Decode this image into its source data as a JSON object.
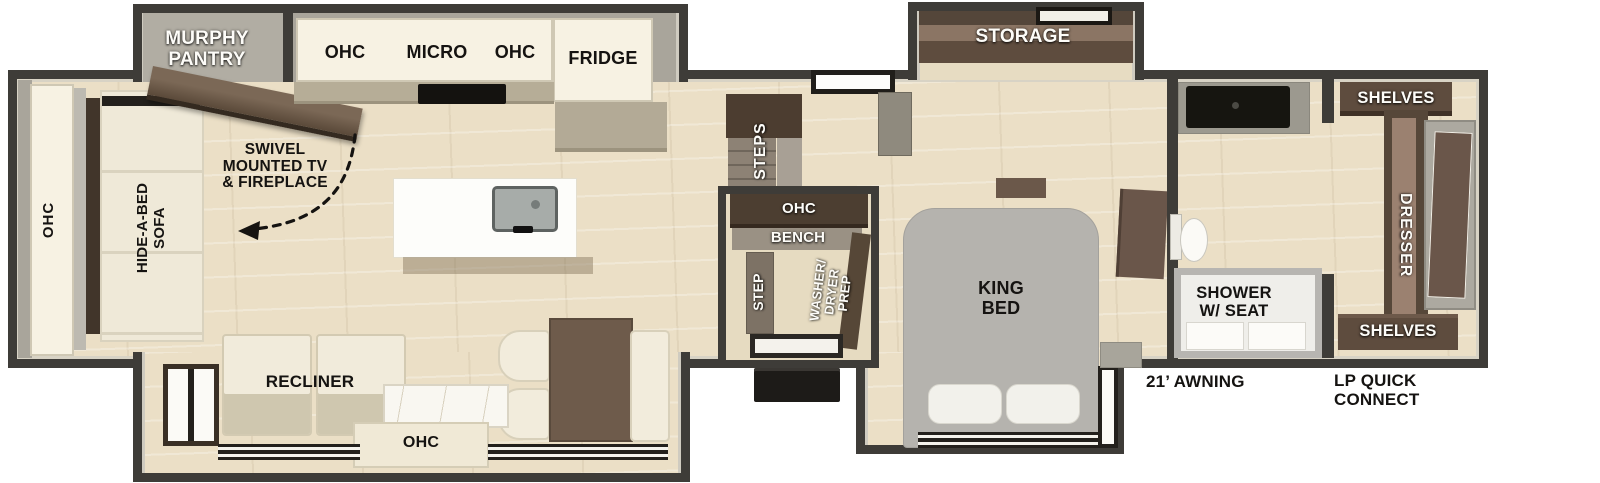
{
  "colors": {
    "wall_dark": "#3E3C38",
    "wall_gray": "#A9A59B",
    "floor_tan": "#EBDFC6",
    "cabinet_white": "#F7F2E3",
    "wood_dark_brown": "#4C3D30",
    "wood_brown": "#6A564A",
    "wood_mid_brown": "#8B7564",
    "bed_gray": "#B5B3AE",
    "upholstery_cream": "#F1EBDB",
    "black_fixture": "#1D1B18"
  },
  "labels": {
    "ohc_rear": "OHC",
    "hide_a_bed": "HIDE-A-BED\nSOFA",
    "murphy_pantry": "MURPHY\nPANTRY",
    "swivel_tv": "SWIVEL\nMOUNTED TV\n& FIREPLACE",
    "kitchen_ohc_left": "OHC",
    "kitchen_micro": "MICRO",
    "kitchen_ohc_right": "OHC",
    "fridge": "FRIDGE",
    "steps": "STEPS",
    "mid_ohc": "OHC",
    "bench": "BENCH",
    "step": "STEP",
    "washer_prep": "WASHER/\nDRYER\nPREP",
    "storage": "STORAGE",
    "king_bed": "KING\nBED",
    "shower": "SHOWER\nW/ SEAT",
    "shelves_top": "SHELVES",
    "dresser": "DRESSER",
    "shelves_bottom": "SHELVES",
    "recliner": "RECLINER",
    "ohc_bottom": "OHC",
    "awning": "21’ AWNING",
    "lp_quick_connect": "LP QUICK\nCONNECT"
  }
}
